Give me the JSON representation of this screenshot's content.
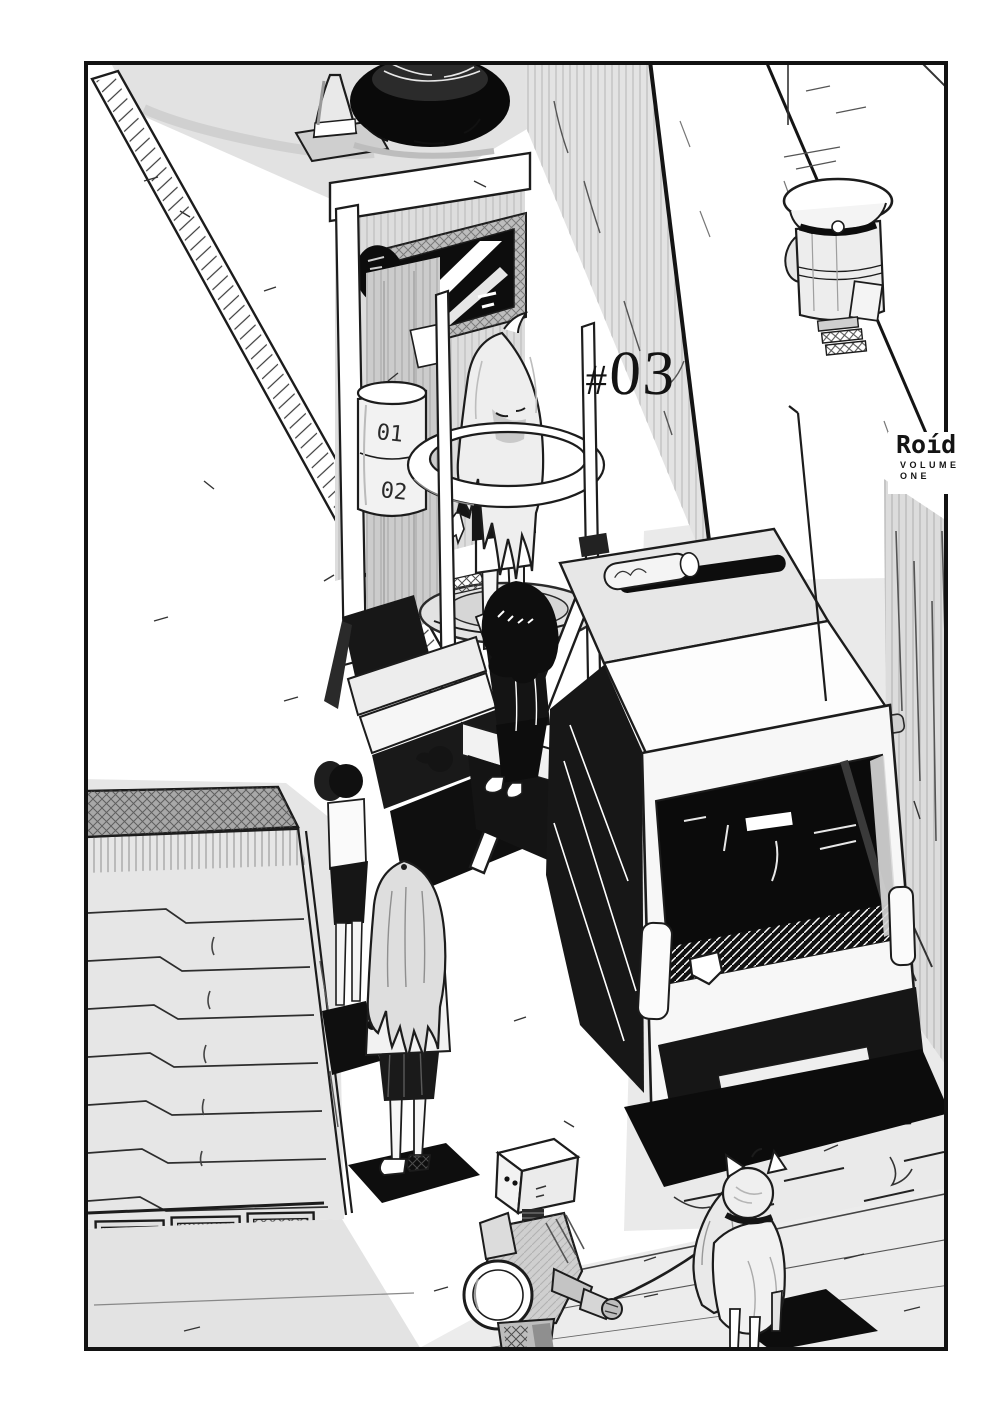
{
  "page": {
    "chapter_number_hash": "#",
    "chapter_number_digits": "03",
    "series_logo": "Roíd",
    "volume_word": "VOLUME",
    "volume_number_word": "ONE"
  },
  "artwork": {
    "barrel_mark_top": "01",
    "barrel_mark_bottom": "02"
  },
  "colors": {
    "ink": "#121212",
    "paper": "#ffffff",
    "tone_light": "#e7e7e7",
    "tone_mid": "#cfcfcf",
    "tone_dark": "#9a9a9a"
  }
}
